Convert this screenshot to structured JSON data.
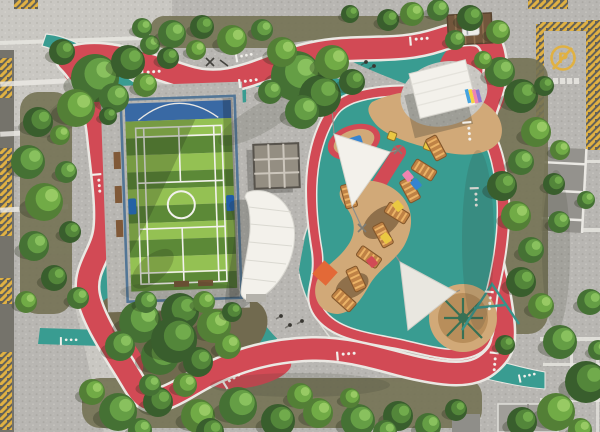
{
  "meta": {
    "title": "Aerial view of a community park with jogging loop, sports court and playground",
    "width": 600,
    "height": 432
  },
  "signs": {
    "no_parking_symbol": "P"
  },
  "colors": {
    "pavement": "#b5b4b0",
    "pavement_light": "#c9c8c3",
    "plaza": "#c3c2bd",
    "road_dark": "#6e6d66",
    "band_white": "#e9e8e4",
    "hatch_yellow": "#dfae3c",
    "track_red": "#d0424e",
    "path_teal": "#2f988e",
    "court_green_light": "#8fbf4c",
    "court_green_dark": "#54842f",
    "court_blue_zone": "#2f62a2",
    "goal_blue": "#1d6fd4",
    "fence_blue": "#4a7093",
    "sand_tan": "#cfa673",
    "sand_deep": "#b58a55",
    "play_brown": "#8a6a44",
    "wood_orange": "#bc7d3e",
    "wood_rung": "#eab061",
    "soil": "#6d6b4e",
    "canopy_white": "#f3f2ed",
    "roof_brown": "#6b4e34",
    "dome_green": "#2f6b4f",
    "accent_orange": "#e2622f",
    "accent_yellow": "#e9c73a",
    "accent_blue": "#2b7fd0",
    "accent_pink": "#ef7fae",
    "accent_purple": "#8a6fd1"
  },
  "foliage_palettes": [
    [
      "#3c6b2c",
      "#5d9a3e",
      "#83bf58"
    ],
    [
      "#2f5724",
      "#4a8132",
      "#6aa845"
    ],
    [
      "#4a7a2e",
      "#6aa83f",
      "#93c95e"
    ]
  ],
  "track_markings": [
    [
      150,
      70,
      -5
    ],
    [
      247,
      79,
      -8
    ],
    [
      418,
      37,
      -5
    ],
    [
      471,
      130,
      85
    ],
    [
      478,
      196,
      88
    ],
    [
      492,
      300,
      95
    ],
    [
      230,
      378,
      -32
    ],
    [
      345,
      352,
      -5
    ],
    [
      101,
      182,
      85
    ],
    [
      497,
      361,
      95
    ]
  ],
  "path_markings": [
    [
      68,
      338,
      0
    ],
    [
      526,
      374,
      -12
    ],
    [
      243,
      54,
      -10
    ],
    [
      90,
      82,
      35
    ]
  ],
  "benches_side": [
    [
      115,
      150
    ],
    [
      115,
      184
    ],
    [
      115,
      218
    ]
  ],
  "benches_bottom": [
    [
      171,
      281
    ],
    [
      195,
      281
    ]
  ],
  "people": [
    [
      366,
      62
    ],
    [
      374,
      66
    ],
    [
      281,
      316
    ],
    [
      290,
      325
    ],
    [
      302,
      321
    ]
  ],
  "cars": [
    [
      462,
      27
    ],
    [
      490,
      26
    ]
  ],
  "sidewalk_bands_left_y": [
    80,
    130,
    206
  ],
  "sidewalk_bands_right": [
    [
      543,
      228,
      57,
      4
    ],
    [
      540,
      337,
      60,
      4
    ],
    [
      543,
      363,
      57,
      3
    ],
    [
      540,
      398,
      60,
      4
    ],
    [
      583,
      160,
      17,
      3
    ]
  ],
  "hatch_bars": [
    [
      0,
      58,
      12,
      40
    ],
    [
      0,
      148,
      12,
      88
    ],
    [
      0,
      278,
      12,
      26
    ],
    [
      0,
      352,
      12,
      78
    ],
    [
      536,
      24,
      8,
      96
    ],
    [
      586,
      20,
      14,
      130
    ],
    [
      540,
      22,
      60,
      9
    ],
    [
      528,
      0,
      40,
      9
    ],
    [
      14,
      0,
      24,
      9
    ]
  ],
  "parking_bays": {
    "x": 543,
    "y": 148,
    "w": 42,
    "h": 84,
    "line_ys": [
      162,
      190,
      218
    ]
  },
  "wood_modules": [
    [
      436,
      148,
      -28
    ],
    [
      424,
      170,
      -58
    ],
    [
      410,
      190,
      -28
    ],
    [
      397,
      213,
      -58
    ],
    [
      383,
      235,
      -28
    ],
    [
      369,
      257,
      -55
    ],
    [
      356,
      279,
      -25
    ],
    [
      344,
      300,
      -48
    ],
    [
      349,
      196,
      -15
    ]
  ],
  "play_accents": [
    [
      416,
      184,
      "#2b7fd0"
    ],
    [
      398,
      206,
      "#e9c73a"
    ],
    [
      386,
      238,
      "#e9c73a"
    ],
    [
      372,
      262,
      "#d0424e"
    ],
    [
      408,
      176,
      "#ef7fae"
    ]
  ],
  "spring_riders": [
    [
      392,
      136
    ],
    [
      428,
      146
    ]
  ],
  "trees": [
    [
      95,
      78,
      24,
      0
    ],
    [
      128,
      62,
      17,
      1
    ],
    [
      76,
      108,
      19,
      2
    ],
    [
      114,
      98,
      15,
      0
    ],
    [
      62,
      52,
      13,
      1
    ],
    [
      145,
      85,
      12,
      2
    ],
    [
      150,
      45,
      10,
      0
    ],
    [
      38,
      122,
      15,
      1
    ],
    [
      28,
      162,
      17,
      0
    ],
    [
      44,
      202,
      19,
      2
    ],
    [
      34,
      246,
      15,
      0
    ],
    [
      54,
      278,
      13,
      1
    ],
    [
      26,
      302,
      11,
      2
    ],
    [
      66,
      172,
      11,
      0
    ],
    [
      70,
      232,
      11,
      1
    ],
    [
      78,
      298,
      11,
      0
    ],
    [
      60,
      135,
      10,
      2
    ],
    [
      172,
      34,
      14,
      0
    ],
    [
      202,
      27,
      12,
      1
    ],
    [
      232,
      40,
      15,
      2
    ],
    [
      262,
      30,
      11,
      0
    ],
    [
      168,
      58,
      11,
      1
    ],
    [
      196,
      50,
      10,
      2
    ],
    [
      142,
      28,
      10,
      0
    ],
    [
      296,
      76,
      25,
      0
    ],
    [
      320,
      96,
      21,
      1
    ],
    [
      332,
      62,
      17,
      2
    ],
    [
      302,
      112,
      17,
      0
    ],
    [
      352,
      82,
      13,
      1
    ],
    [
      282,
      52,
      15,
      2
    ],
    [
      270,
      92,
      12,
      0
    ],
    [
      388,
      20,
      11,
      1
    ],
    [
      412,
      14,
      12,
      2
    ],
    [
      438,
      10,
      11,
      0
    ],
    [
      470,
      18,
      13,
      1
    ],
    [
      498,
      32,
      12,
      2
    ],
    [
      455,
      40,
      10,
      0
    ],
    [
      350,
      14,
      9,
      1
    ],
    [
      500,
      72,
      15,
      0
    ],
    [
      521,
      96,
      17,
      1
    ],
    [
      536,
      132,
      15,
      2
    ],
    [
      521,
      162,
      13,
      0
    ],
    [
      502,
      186,
      15,
      1
    ],
    [
      516,
      216,
      15,
      2
    ],
    [
      531,
      250,
      13,
      0
    ],
    [
      521,
      282,
      15,
      1
    ],
    [
      541,
      306,
      13,
      2
    ],
    [
      559,
      222,
      11,
      0
    ],
    [
      554,
      184,
      11,
      1
    ],
    [
      560,
      150,
      10,
      2
    ],
    [
      586,
      200,
      9,
      0
    ],
    [
      544,
      86,
      10,
      1
    ],
    [
      560,
      342,
      17,
      0
    ],
    [
      586,
      382,
      21,
      1
    ],
    [
      556,
      412,
      19,
      2
    ],
    [
      590,
      302,
      13,
      0
    ],
    [
      522,
      422,
      15,
      1
    ],
    [
      580,
      430,
      12,
      2
    ],
    [
      598,
      350,
      10,
      0
    ],
    [
      118,
      412,
      19,
      0
    ],
    [
      158,
      402,
      15,
      1
    ],
    [
      198,
      416,
      17,
      2
    ],
    [
      238,
      406,
      19,
      0
    ],
    [
      278,
      421,
      17,
      1
    ],
    [
      318,
      413,
      15,
      2
    ],
    [
      358,
      421,
      17,
      0
    ],
    [
      398,
      416,
      15,
      1
    ],
    [
      300,
      396,
      13,
      2
    ],
    [
      428,
      426,
      13,
      0
    ],
    [
      456,
      410,
      11,
      1
    ],
    [
      92,
      392,
      13,
      2
    ],
    [
      140,
      430,
      12,
      0
    ],
    [
      210,
      432,
      14,
      1
    ],
    [
      350,
      398,
      10,
      2
    ],
    [
      385,
      432,
      12,
      0
    ],
    [
      140,
      322,
      21,
      0
    ],
    [
      180,
      312,
      19,
      1
    ],
    [
      214,
      326,
      17,
      2
    ],
    [
      160,
      356,
      19,
      0
    ],
    [
      198,
      362,
      15,
      1
    ],
    [
      228,
      346,
      13,
      2
    ],
    [
      120,
      346,
      15,
      0
    ],
    [
      174,
      340,
      23,
      1
    ],
    [
      204,
      302,
      11,
      2
    ],
    [
      146,
      302,
      11,
      0
    ],
    [
      232,
      312,
      10,
      1
    ],
    [
      185,
      385,
      12,
      2
    ],
    [
      150,
      385,
      11,
      0
    ],
    [
      108,
      116,
      9,
      1
    ],
    [
      483,
      60,
      9,
      2
    ],
    [
      505,
      345,
      10,
      1
    ]
  ]
}
